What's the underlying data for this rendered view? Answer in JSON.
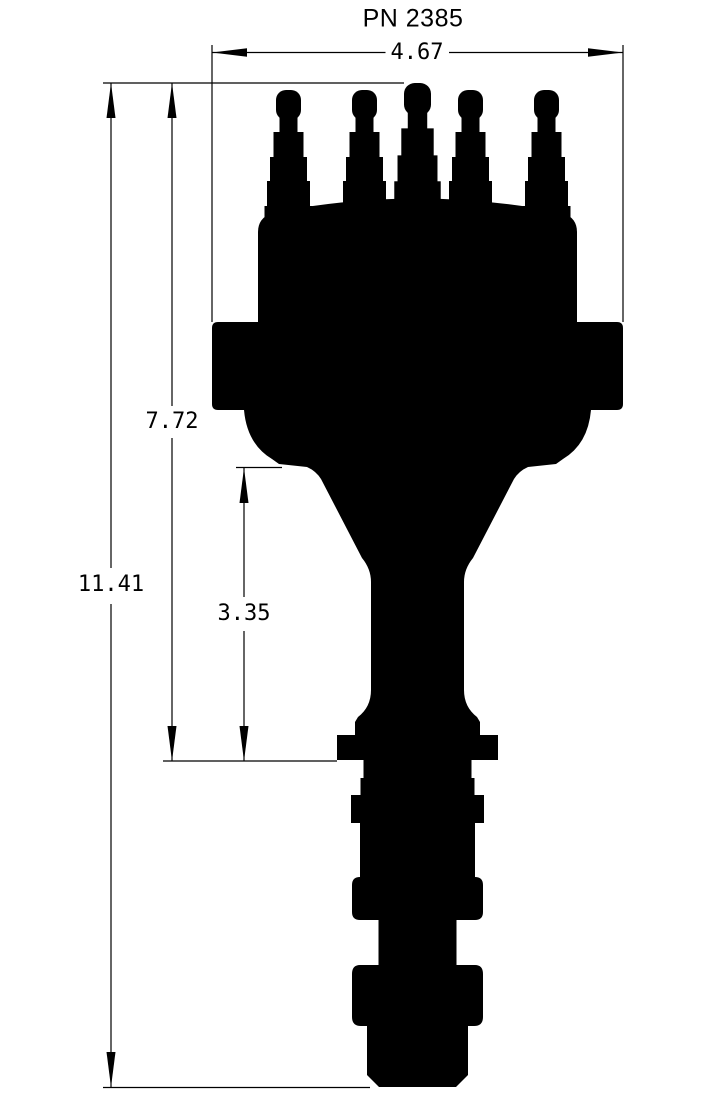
{
  "drawing": {
    "title": "PN 2385",
    "part": "distributor-side-view-silhouette",
    "dims": {
      "width": "4.67",
      "height_cap_to_stop": "7.72",
      "height_overall": "11.41",
      "height_lower_section": "3.35"
    }
  },
  "colors": {
    "ink": "#000000",
    "background": "#ffffff"
  }
}
